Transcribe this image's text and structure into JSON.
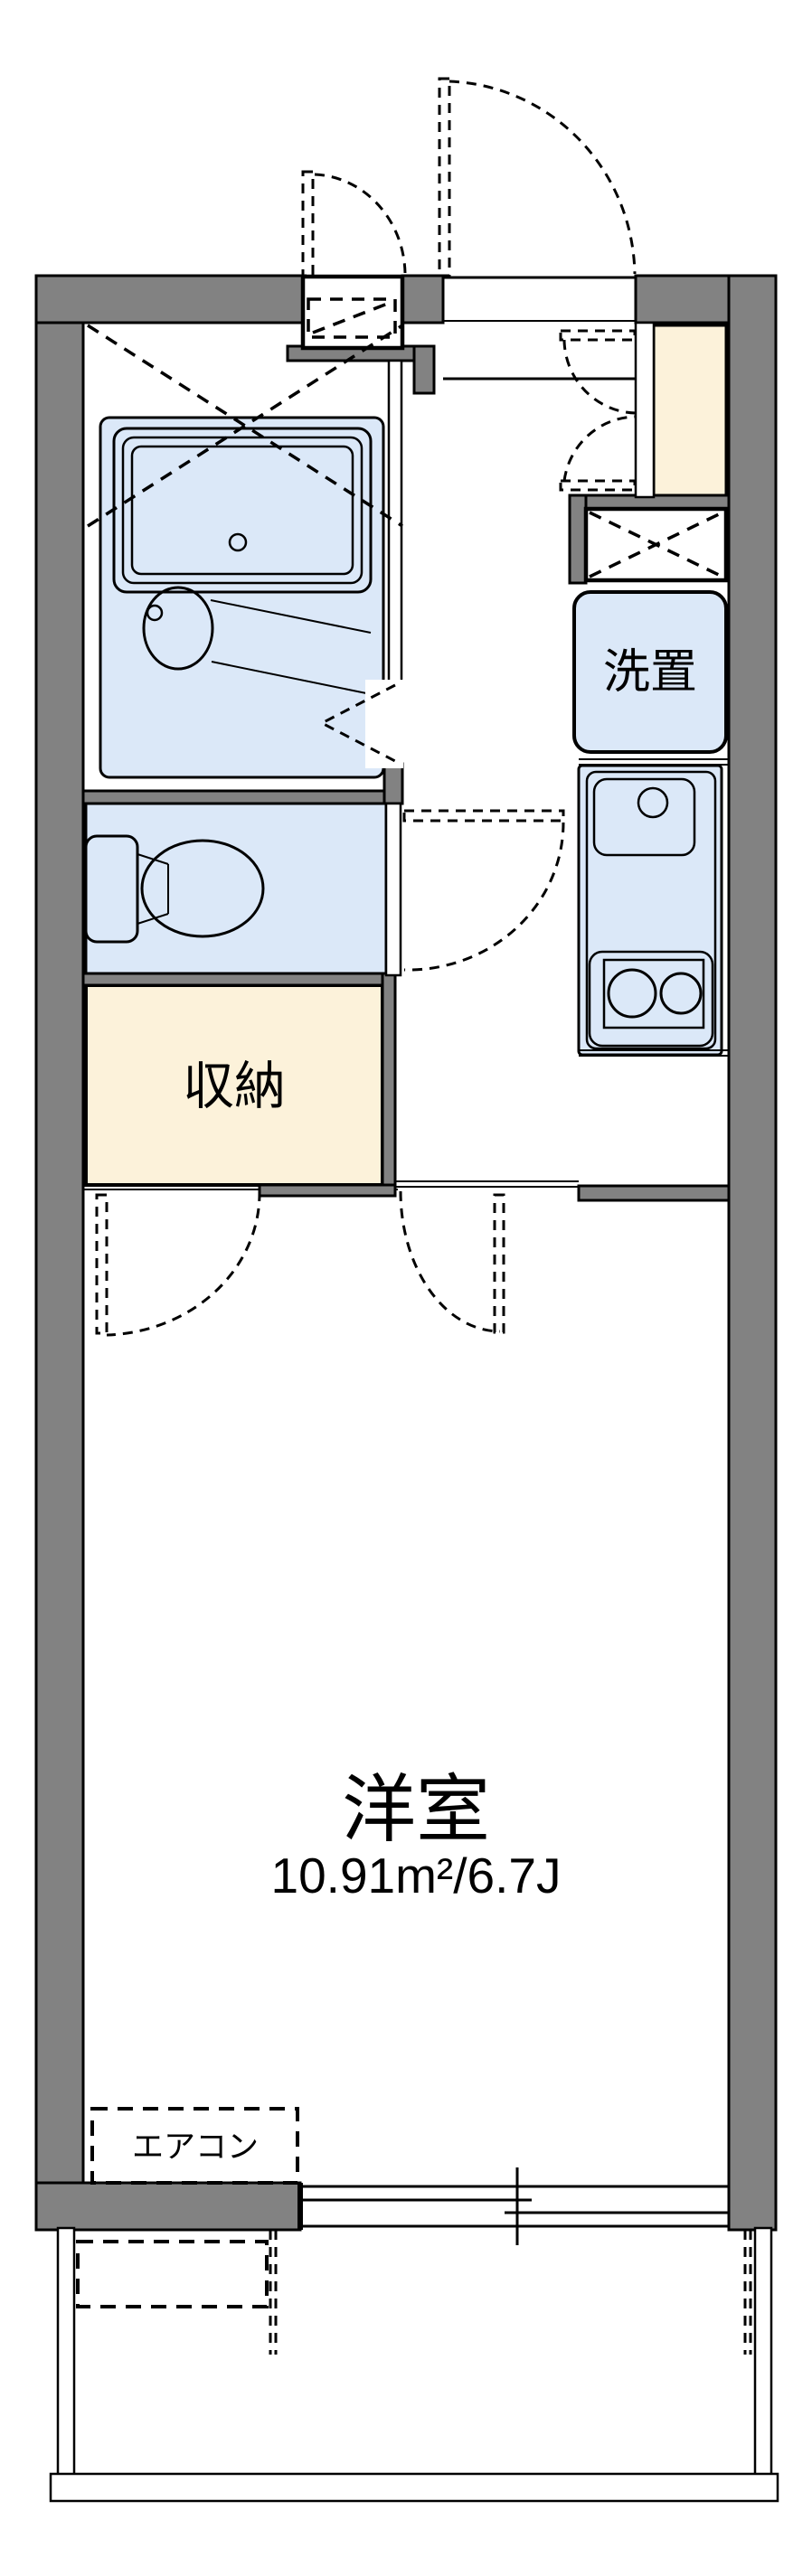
{
  "document": {
    "type": "floorplan",
    "language": "ja"
  },
  "labels": {
    "laundry": "洗置",
    "storage": "収納",
    "western_room": "洋室",
    "western_room_size": "10.91m²/6.7J",
    "aircon": "エアコン"
  },
  "colors": {
    "wall": "#828282",
    "water_area": "#dbe8f8",
    "wood_area": "#fcf2da",
    "line": "#000000",
    "background": "#ffffff"
  }
}
